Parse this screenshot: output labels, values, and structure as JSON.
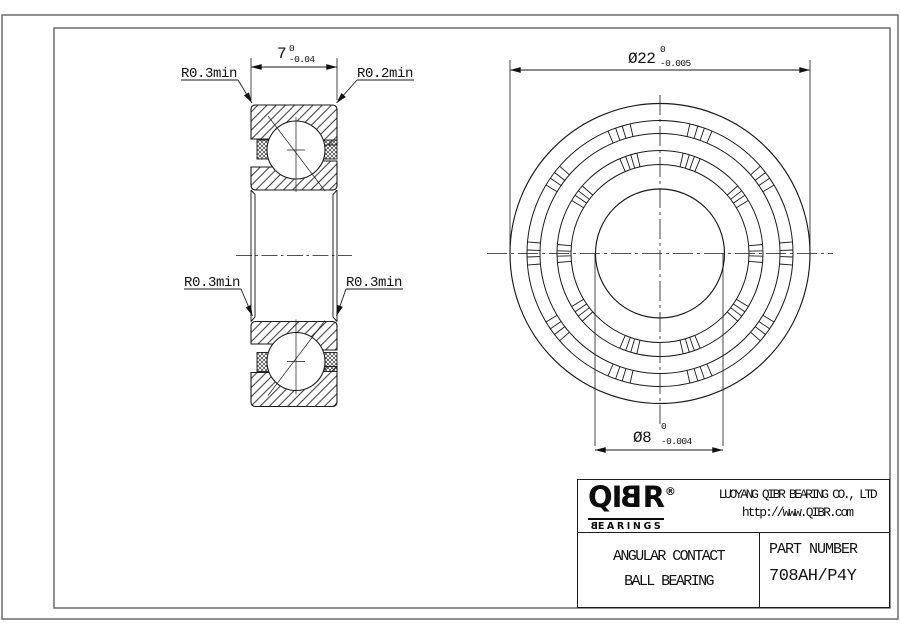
{
  "colors": {
    "background": "#ffffff",
    "drawing_line": "#1a1a1a",
    "frame_line": "#747474",
    "text": "#111111"
  },
  "side_view": {
    "width_dim": {
      "nominal": "7",
      "upper_tol": "0",
      "lower_tol": "-0.04"
    },
    "fillet_top_left": "R0.3min",
    "fillet_top_right": "R0.2min",
    "fillet_bottom_left": "R0.3min",
    "fillet_bottom_right": "R0.3min"
  },
  "front_view": {
    "od_dim": {
      "nominal": "Ø22",
      "upper_tol": "0",
      "lower_tol": "-0.005"
    },
    "bore_dim": {
      "nominal": "Ø8",
      "upper_tol": "0",
      "lower_tol": "-0.004"
    }
  },
  "title_block": {
    "logo": {
      "pre": "QI",
      "mirrored": "B",
      "post": "R",
      "reg": "®",
      "sub_mirrored": "B",
      "sub_rest": "EARINGS"
    },
    "company": "LUOYANG QIBR BEARING CO., LTD",
    "website": "http://www.QIBR.com",
    "product_line1": "ANGULAR CONTACT",
    "product_line2": "BALL BEARING",
    "part_number_label": "PART NUMBER",
    "part_number": "708AH/P4Y"
  }
}
